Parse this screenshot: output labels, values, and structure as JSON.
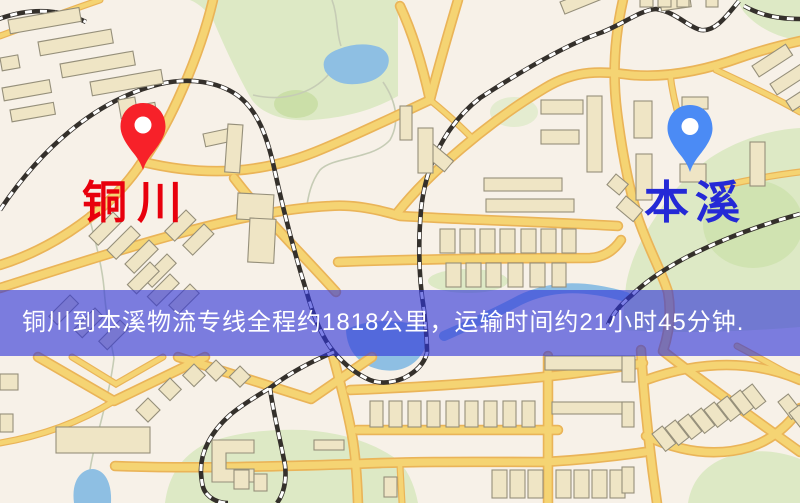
{
  "banner": {
    "text": "铜川到本溪物流专线全程约1818公里，运输时间约21小时45分钟."
  },
  "origin": {
    "label": "铜川"
  },
  "destination": {
    "label": "本溪"
  },
  "colors": {
    "background": "#f7f1e8",
    "park": "#dde9c6",
    "park_dark": "#cbdfa9",
    "water": "#8fbfe2",
    "road_fill": "#f4d476",
    "road_case": "#e9b45b",
    "building": "#efe5c6",
    "building_line": "#958f7b",
    "railway": "#34302b",
    "origin_pin": "#f2222a",
    "destination_pin": "#4d8bf2",
    "origin_label": "#e8000d",
    "destination_label": "#2429d6",
    "banner_bg": "rgba(47,51,217,0.62)",
    "banner_text": "#ffffff"
  }
}
